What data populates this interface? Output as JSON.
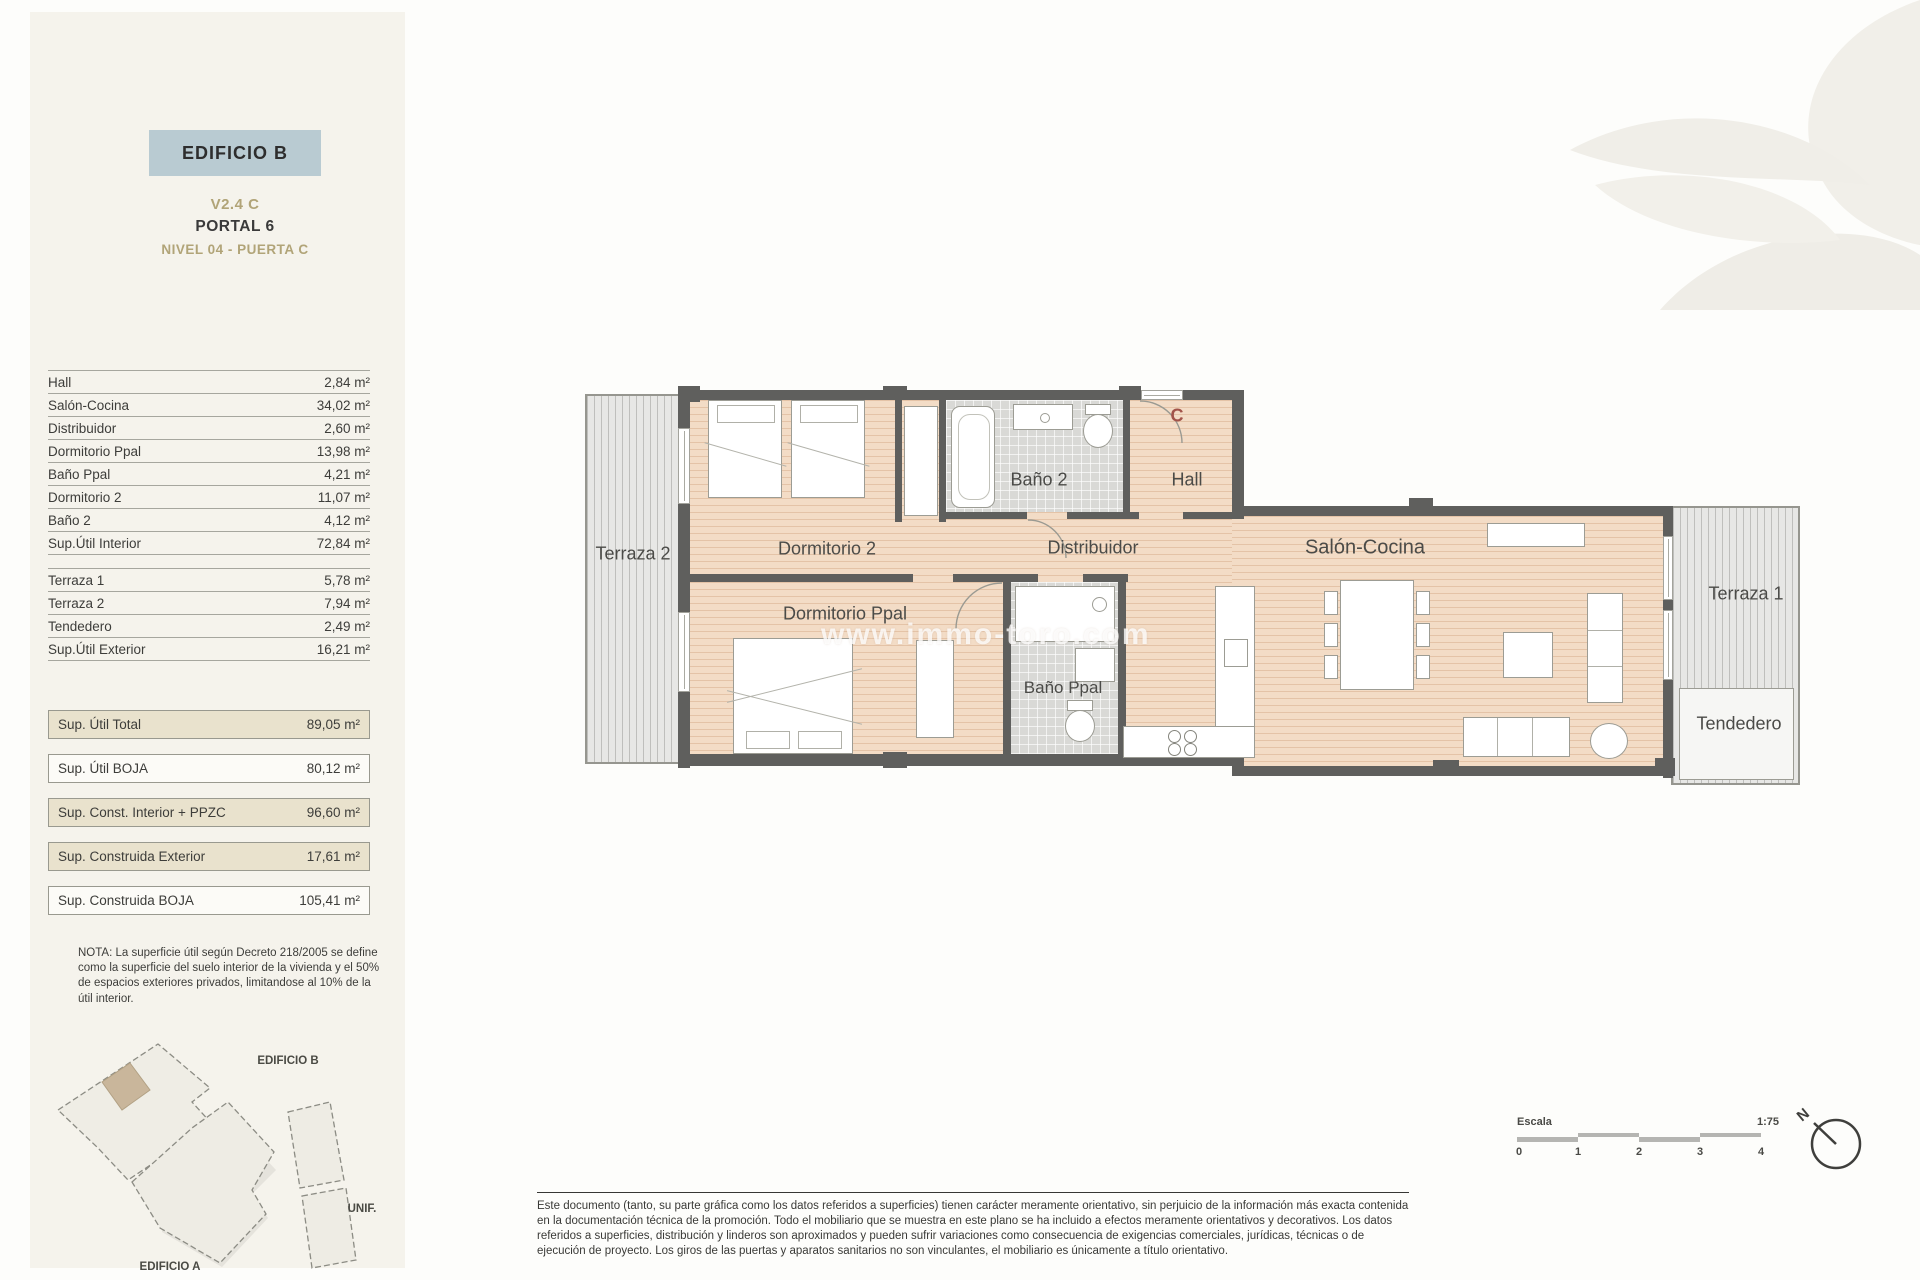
{
  "header": {
    "building": "EDIFICIO B",
    "unit": "V2.4 C",
    "portal": "PORTAL 6",
    "level": "NIVEL 04 - PUERTA C"
  },
  "area_table": {
    "interior": [
      {
        "label": "Hall",
        "value": "2,84 m²"
      },
      {
        "label": "Salón-Cocina",
        "value": "34,02 m²"
      },
      {
        "label": "Distribuidor",
        "value": "2,60 m²"
      },
      {
        "label": "Dormitorio Ppal",
        "value": "13,98 m²"
      },
      {
        "label": "Baño Ppal",
        "value": "4,21 m²"
      },
      {
        "label": "Dormitorio 2",
        "value": "11,07 m²"
      },
      {
        "label": "Baño 2",
        "value": "4,12 m²"
      },
      {
        "label": "Sup.Útil Interior",
        "value": "72,84 m²"
      }
    ],
    "exterior": [
      {
        "label": "Terraza 1",
        "value": "5,78 m²"
      },
      {
        "label": "Terraza 2",
        "value": "7,94 m²"
      },
      {
        "label": "Tendedero",
        "value": "2,49 m²"
      },
      {
        "label": "Sup.Útil Exterior",
        "value": "16,21 m²"
      }
    ],
    "totals": [
      {
        "label": "Sup. Útil Total",
        "value": "89,05 m²"
      },
      {
        "label": "Sup. Útil BOJA",
        "value": "80,12 m²"
      },
      {
        "label": "Sup. Const. Interior + PPZC",
        "value": "96,60 m²"
      },
      {
        "label": "Sup. Construida Exterior",
        "value": "17,61 m²"
      },
      {
        "label": "Sup. Construida BOJA",
        "value": "105,41 m²"
      }
    ]
  },
  "note": "NOTA: La superficie útil según Decreto 218/2005 se define como la superficie del suelo interior de la vivienda y el 50% de espacios exteriores privados, limitandose al 10% de la útil interior.",
  "site_plan": {
    "label_b": "EDIFICIO B",
    "label_unif": "UNIF.",
    "label_a": "EDIFICIO A"
  },
  "floor_plan": {
    "door_label": "C",
    "watermark": "www.immo-toro.com",
    "rooms": {
      "terraza2": "Terraza 2",
      "dormitorio2": "Dormitorio 2",
      "bano2": "Baño 2",
      "hall": "Hall",
      "distribuidor": "Distribuidor",
      "dormitorio_ppal": "Dormitorio Ppal",
      "bano_ppal": "Baño Ppal",
      "salon": "Salón-Cocina",
      "terraza1": "Terraza 1",
      "tendedero": "Tendedero"
    }
  },
  "scale_bar": {
    "label": "Escala",
    "ratio": "1:75",
    "ticks": [
      "0",
      "1",
      "2",
      "3",
      "4"
    ],
    "north": "N"
  },
  "disclaimer": "Este documento (tanto, su parte gráfica como los datos referidos a superficies) tienen carácter meramente orientativo, sin perjuicio de la información más exacta contenida en la documentación técnica de la promoción. Todo el mobiliario que se muestra en este plano se ha incluido a efectos meramente orientativos y decorativos. Los datos referidos a superficies, distribución y linderos son aproximados y pueden sufrir variaciones como consecuencia de exigencias comerciales, jurídicas, técnicas o de ejecución de proyecto. Los giros de las puertas y aparatos sanitarios no son vinculantes, el mobiliario es únicamente a título orientativo.",
  "colors": {
    "accent_gold": "#b1a478",
    "header_box": "#b9cbd2",
    "wall": "#5f5f5d",
    "door_letter": "#a2544a",
    "shaded_row": "#e9e2cd"
  }
}
